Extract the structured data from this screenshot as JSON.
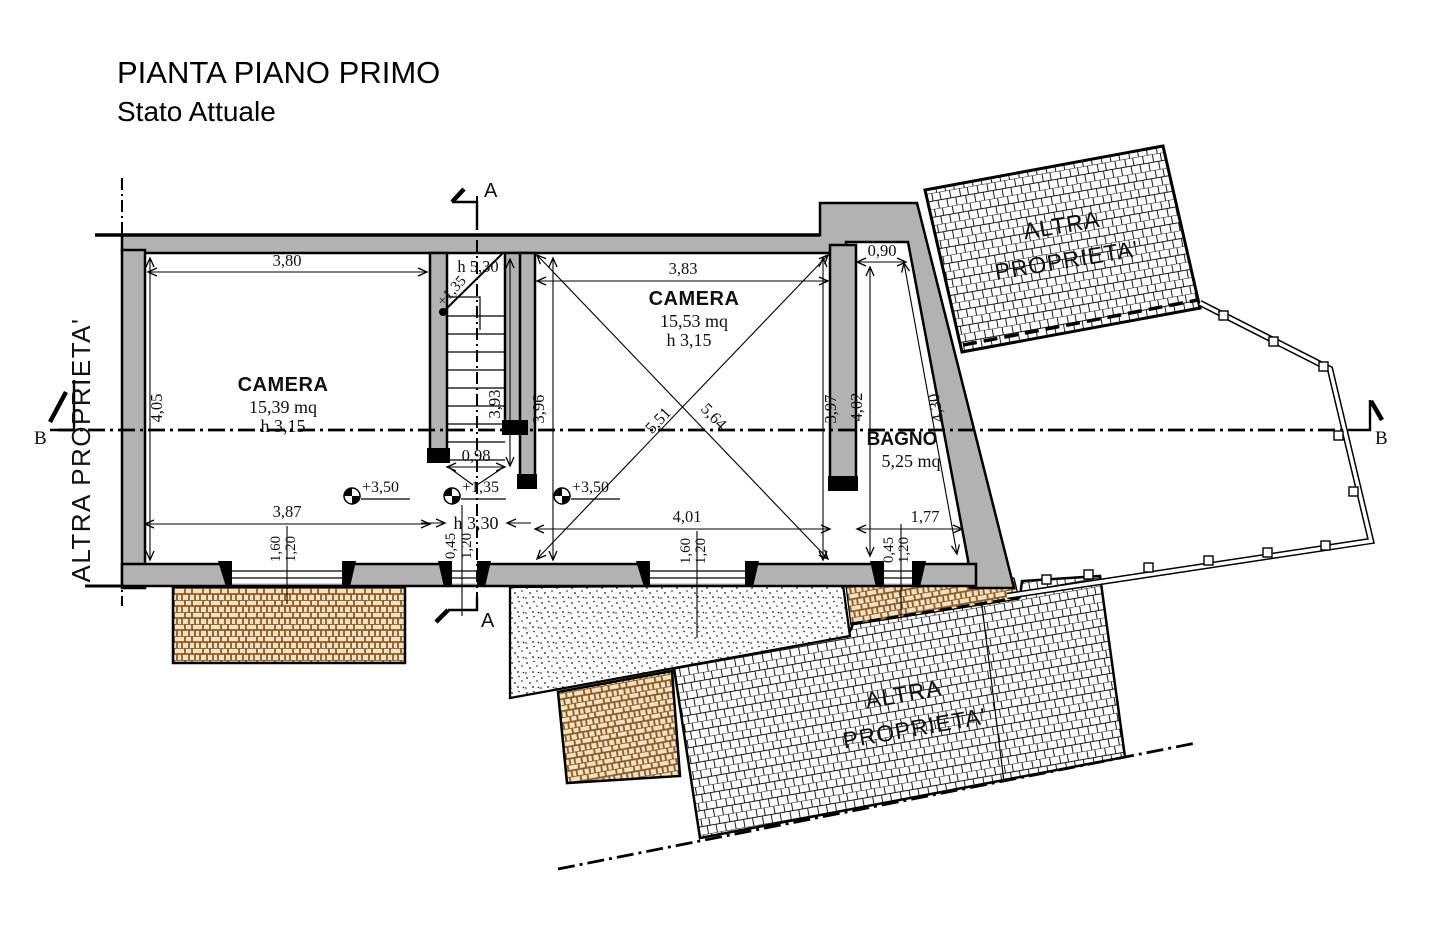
{
  "title": {
    "line1": "PIANTA PIANO PRIMO",
    "line2": "Stato Attuale"
  },
  "neighbor": {
    "full": "ALTRA PROPRIETA'",
    "line1": "ALTRA",
    "line2": "PROPRIETA'"
  },
  "sections": {
    "a": "A",
    "b": "B"
  },
  "rooms": {
    "camera1": {
      "name": "CAMERA",
      "area": "15,39 mq",
      "height": "h 3,15",
      "level": "+3,50",
      "dims": {
        "top": "3,80",
        "left": "4,05",
        "bottom": "3,87",
        "window_w": "1,60",
        "window_h": "1,20"
      }
    },
    "camera2": {
      "name": "CAMERA",
      "area": "15,53 mq",
      "height": "h 3,15",
      "level": "+3,50",
      "dims": {
        "top": "3,83",
        "left": "3,96",
        "right": "3,97",
        "bottom": "4,01",
        "diag_a": "5,51",
        "diag_b": "5,64",
        "window_w": "1,60",
        "window_h": "1,20"
      }
    },
    "bagno": {
      "name": "BAGNO",
      "area": "5,25 mq",
      "dims": {
        "top": "0,90",
        "left": "4,02",
        "diag": "4,30",
        "bottom": "1,77",
        "window_w": "0,45",
        "window_h": "1,20"
      }
    },
    "stairs": {
      "headroom": "h 5,30",
      "flight_level": "+1,35",
      "landing_level": "+1,35",
      "dims": {
        "width": "0,98",
        "length": "3,93",
        "passage": "h 3,30",
        "window_w": "0,45",
        "window_h": "1,20"
      }
    }
  },
  "colors": {
    "wall_fill": "#b2b2b2",
    "line": "#000000",
    "brick_line": "#8a5a28",
    "brick_bg": "#f3e2c2",
    "paper": "#ffffff"
  }
}
